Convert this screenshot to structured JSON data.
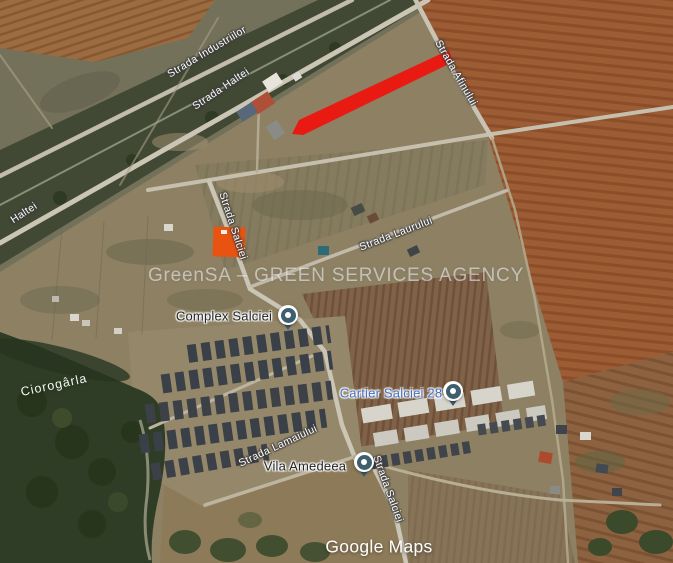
{
  "map": {
    "watermark": "GreenSA – GREEN SERVICES AGENCY",
    "attribution": {
      "google": "Google",
      "maps": "Maps"
    },
    "streets": {
      "industriilor": "Strada Industriilor",
      "haltei": "Strada Haltei",
      "haltei_short": "Haltei",
      "afinului": "Strada Afinului",
      "salciei_north": "Strada Salciei",
      "laurului": "Strada Laurului",
      "lamaiului": "Strada Lamaiului",
      "salciei_south": "Strada Salciei"
    },
    "water": {
      "ciorogarla": "Ciorogârla"
    },
    "places": {
      "complex_salciei": "Complex Salciei",
      "cartier_salciei": "Cartier Salciei 28",
      "vila_amedeea": "Vila Amedeea"
    },
    "annotation": {
      "shape": "red-line",
      "color": "#e91a12"
    },
    "colors": {
      "poi_pin": "#3e5f6e",
      "business_label_blue": "#4470c4",
      "street_label_white": "#ffffff",
      "field_brown": "#9c5c34",
      "plowed_field": "#7f6248",
      "forest_green": "#2f3d26",
      "scrub_olive": "#74715a",
      "road_gray": "#cbc5b6"
    }
  }
}
